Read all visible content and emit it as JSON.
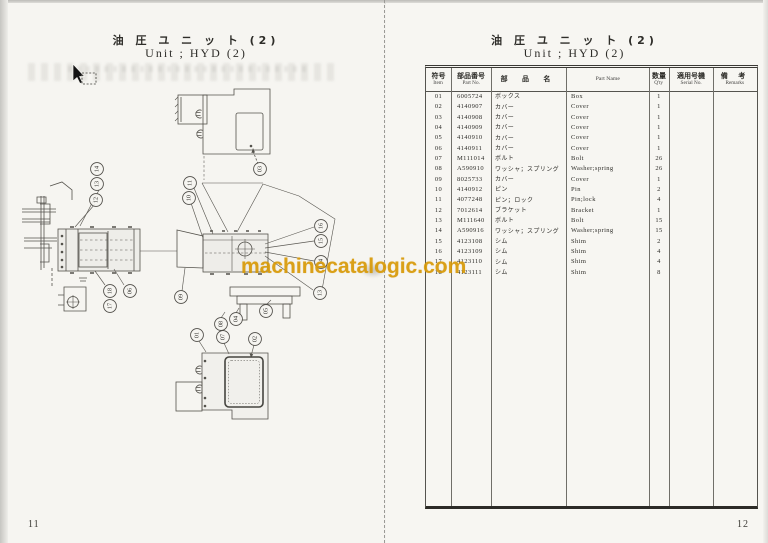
{
  "watermark": {
    "text": "machinecatalogic.com",
    "color": "#d89a08"
  },
  "left_page": {
    "title_jp": "油 圧 ユ ニ ッ ト (2)",
    "title_en": "Unit ; HYD (2)",
    "page_number": "11",
    "diagram": {
      "callouts": [
        {
          "label": "14",
          "x": 97,
          "y": 169
        },
        {
          "label": "13",
          "x": 97,
          "y": 184
        },
        {
          "label": "12",
          "x": 96,
          "y": 200
        },
        {
          "label": "18",
          "x": 110,
          "y": 291
        },
        {
          "label": "17",
          "x": 110,
          "y": 306
        },
        {
          "label": "06",
          "x": 130,
          "y": 291
        },
        {
          "label": "03",
          "x": 260,
          "y": 169
        },
        {
          "label": "11",
          "x": 190,
          "y": 183
        },
        {
          "label": "10",
          "x": 189,
          "y": 198
        },
        {
          "label": "09",
          "x": 181,
          "y": 297
        },
        {
          "label": "16",
          "x": 321,
          "y": 226
        },
        {
          "label": "15",
          "x": 321,
          "y": 241
        },
        {
          "label": "14",
          "x": 321,
          "y": 262
        },
        {
          "label": "13",
          "x": 320,
          "y": 293
        },
        {
          "label": "05",
          "x": 266,
          "y": 311
        },
        {
          "label": "04",
          "x": 236,
          "y": 319
        },
        {
          "label": "08",
          "x": 221,
          "y": 324
        },
        {
          "label": "07",
          "x": 223,
          "y": 337
        },
        {
          "label": "01",
          "x": 197,
          "y": 335
        },
        {
          "label": "02",
          "x": 255,
          "y": 339
        }
      ],
      "leaders": [
        [
          95,
          204,
          75,
          227
        ],
        [
          99,
          190,
          80,
          226
        ],
        [
          105,
          285,
          95,
          271
        ],
        [
          124,
          285,
          114,
          269
        ],
        [
          191,
          203,
          203,
          238
        ],
        [
          194,
          188,
          213,
          234
        ],
        [
          185,
          268,
          182,
          291
        ],
        [
          265,
          244,
          314,
          227
        ],
        [
          265,
          248,
          314,
          241
        ],
        [
          265,
          252,
          314,
          261
        ],
        [
          265,
          256,
          313,
          290
        ],
        [
          266,
          305,
          271,
          300
        ],
        [
          236,
          313,
          239,
          308
        ],
        [
          221,
          318,
          225,
          312
        ],
        [
          224,
          343,
          229,
          354
        ],
        [
          199,
          341,
          206,
          352
        ],
        [
          254,
          345,
          251,
          356
        ]
      ]
    }
  },
  "right_page": {
    "title_jp": "油 圧 ユ ニ ッ ト (2)",
    "title_en": "Unit ; HYD (2)",
    "page_number": "12",
    "table": {
      "headers": [
        {
          "jp": "符号",
          "en": "Item"
        },
        {
          "jp": "部品番号",
          "en": "Part No."
        },
        {
          "jp": "部 品 名",
          "en": ""
        },
        {
          "jp": "",
          "en": "Part Name"
        },
        {
          "jp": "数量",
          "en": "Q'ty"
        },
        {
          "jp": "適用号機",
          "en": "Serial No."
        },
        {
          "jp": "備 考",
          "en": "Remarks"
        }
      ],
      "rows": [
        {
          "item": "01",
          "part_no": "6005724",
          "name_jp": "ボックス",
          "name_en": "Box",
          "qty": "1",
          "serial": "",
          "remarks": ""
        },
        {
          "item": "02",
          "part_no": "4140907",
          "name_jp": "カバー",
          "name_en": "Cover",
          "qty": "1",
          "serial": "",
          "remarks": ""
        },
        {
          "item": "03",
          "part_no": "4140908",
          "name_jp": "カバー",
          "name_en": "Cover",
          "qty": "1",
          "serial": "",
          "remarks": ""
        },
        {
          "item": "04",
          "part_no": "4140909",
          "name_jp": "カバー",
          "name_en": "Cover",
          "qty": "1",
          "serial": "",
          "remarks": ""
        },
        {
          "item": "05",
          "part_no": "4140910",
          "name_jp": "カバー",
          "name_en": "Cover",
          "qty": "1",
          "serial": "",
          "remarks": ""
        },
        {
          "item": "06",
          "part_no": "4140911",
          "name_jp": "カバー",
          "name_en": "Cover",
          "qty": "1",
          "serial": "",
          "remarks": ""
        },
        {
          "item": "07",
          "part_no": "M111014",
          "name_jp": "ボルト",
          "name_en": "Bolt",
          "qty": "26",
          "serial": "",
          "remarks": ""
        },
        {
          "item": "08",
          "part_no": "A590910",
          "name_jp": "ワッシャ；スプリング",
          "name_en": "Washer;spring",
          "qty": "26",
          "serial": "",
          "remarks": ""
        },
        {
          "item": "09",
          "part_no": "8025733",
          "name_jp": "カバー",
          "name_en": "Cover",
          "qty": "1",
          "serial": "",
          "remarks": ""
        },
        {
          "item": "10",
          "part_no": "4140912",
          "name_jp": "ピン",
          "name_en": "Pin",
          "qty": "2",
          "serial": "",
          "remarks": ""
        },
        {
          "item": "11",
          "part_no": "4077248",
          "name_jp": "ピン；ロック",
          "name_en": "Pin;lock",
          "qty": "4",
          "serial": "",
          "remarks": ""
        },
        {
          "item": "12",
          "part_no": "7012614",
          "name_jp": "ブラケット",
          "name_en": "Bracket",
          "qty": "1",
          "serial": "",
          "remarks": ""
        },
        {
          "item": "13",
          "part_no": "M111640",
          "name_jp": "ボルト",
          "name_en": "Bolt",
          "qty": "15",
          "serial": "",
          "remarks": ""
        },
        {
          "item": "14",
          "part_no": "A590916",
          "name_jp": "ワッシャ；スプリング",
          "name_en": "Washer;spring",
          "qty": "15",
          "serial": "",
          "remarks": ""
        },
        {
          "item": "15",
          "part_no": "4123108",
          "name_jp": "シム",
          "name_en": "Shim",
          "qty": "2",
          "serial": "",
          "remarks": ""
        },
        {
          "item": "16",
          "part_no": "4123109",
          "name_jp": "シム",
          "name_en": "Shim",
          "qty": "4",
          "serial": "",
          "remarks": ""
        },
        {
          "item": "17",
          "part_no": "4123110",
          "name_jp": "シム",
          "name_en": "Shim",
          "qty": "4",
          "serial": "",
          "remarks": ""
        },
        {
          "item": "18",
          "part_no": "4123111",
          "name_jp": "シム",
          "name_en": "Shim",
          "qty": "8",
          "serial": "",
          "remarks": ""
        }
      ]
    }
  }
}
